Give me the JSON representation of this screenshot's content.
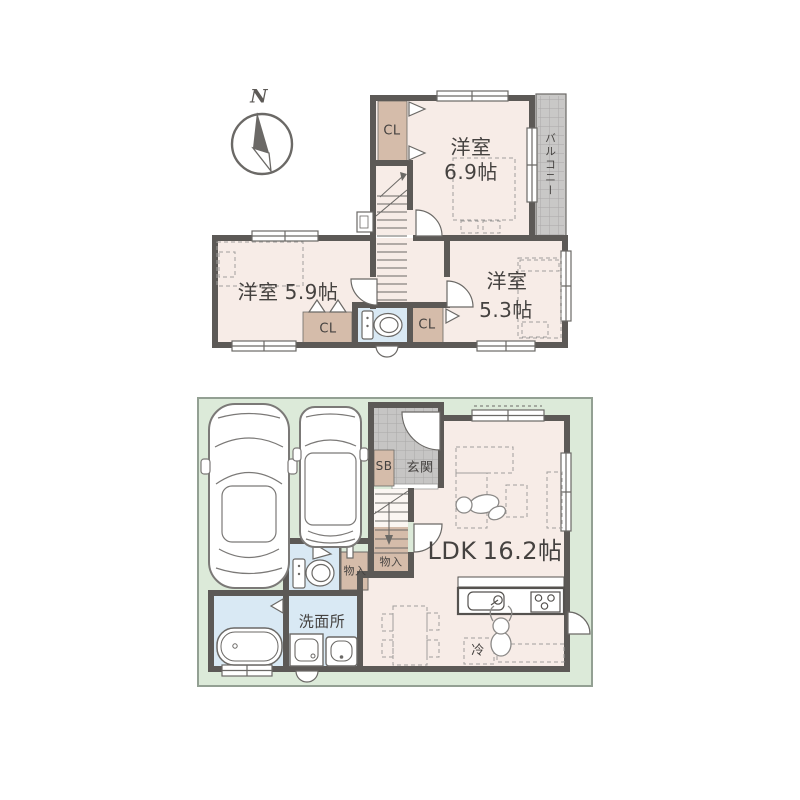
{
  "compass": {
    "north_label": "N"
  },
  "floor2": {
    "room_69": {
      "name": "洋室",
      "size": "6.9帖"
    },
    "room_59": {
      "name": "洋室",
      "size": "5.9帖"
    },
    "room_53": {
      "name": "洋室",
      "size": "5.3帖"
    },
    "balcony_label": "バルコニー",
    "closet_upper_label": "CL",
    "closet_59_label": "CL",
    "closet_53_label": "CL"
  },
  "floor1": {
    "ldk": {
      "name": "LDK",
      "size": "16.2帖"
    },
    "entrance_label": "玄関",
    "shoebox_label": "SB",
    "storage_under_stairs_label": "物入",
    "storage_hall_label": "物入",
    "washroom_label": "洗面所",
    "refrigerator_label": "冷"
  },
  "colors": {
    "wall": "#5c5956",
    "room_floor": "#f7ece7",
    "closet_tan": "#d5bcaa",
    "water_blue": "#d9e9f4",
    "tile_gray": "#c6c5c4",
    "lot_green": "#dcead9",
    "text": "#454240"
  }
}
